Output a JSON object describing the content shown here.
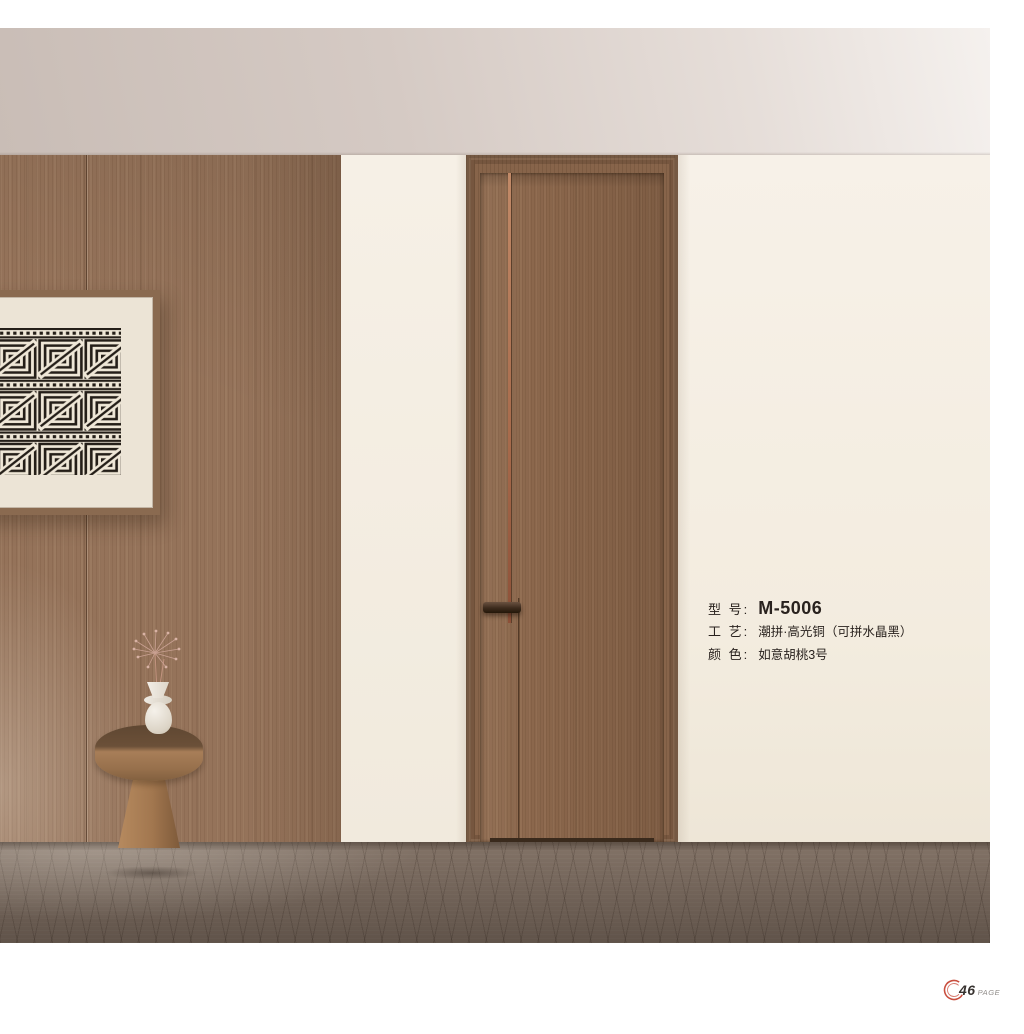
{
  "spec": {
    "model": {
      "label": "型 号:",
      "value": "M-5006"
    },
    "craft": {
      "label": "工 艺:",
      "value": "潮拼·高光铜（可拼水晶黑）"
    },
    "color": {
      "label": "颜 色:",
      "value": "如意胡桃3号"
    }
  },
  "footer": {
    "page_number": "46",
    "page_suffix": "PAGE"
  },
  "colors": {
    "accent_ring": "#c94f3f",
    "wall_wood": "#95735a",
    "door_wood": "#8b674c",
    "copper_inlay": "#a76a4b",
    "cream_wall": "#f3ecdf",
    "floor": "#8c7c70"
  }
}
